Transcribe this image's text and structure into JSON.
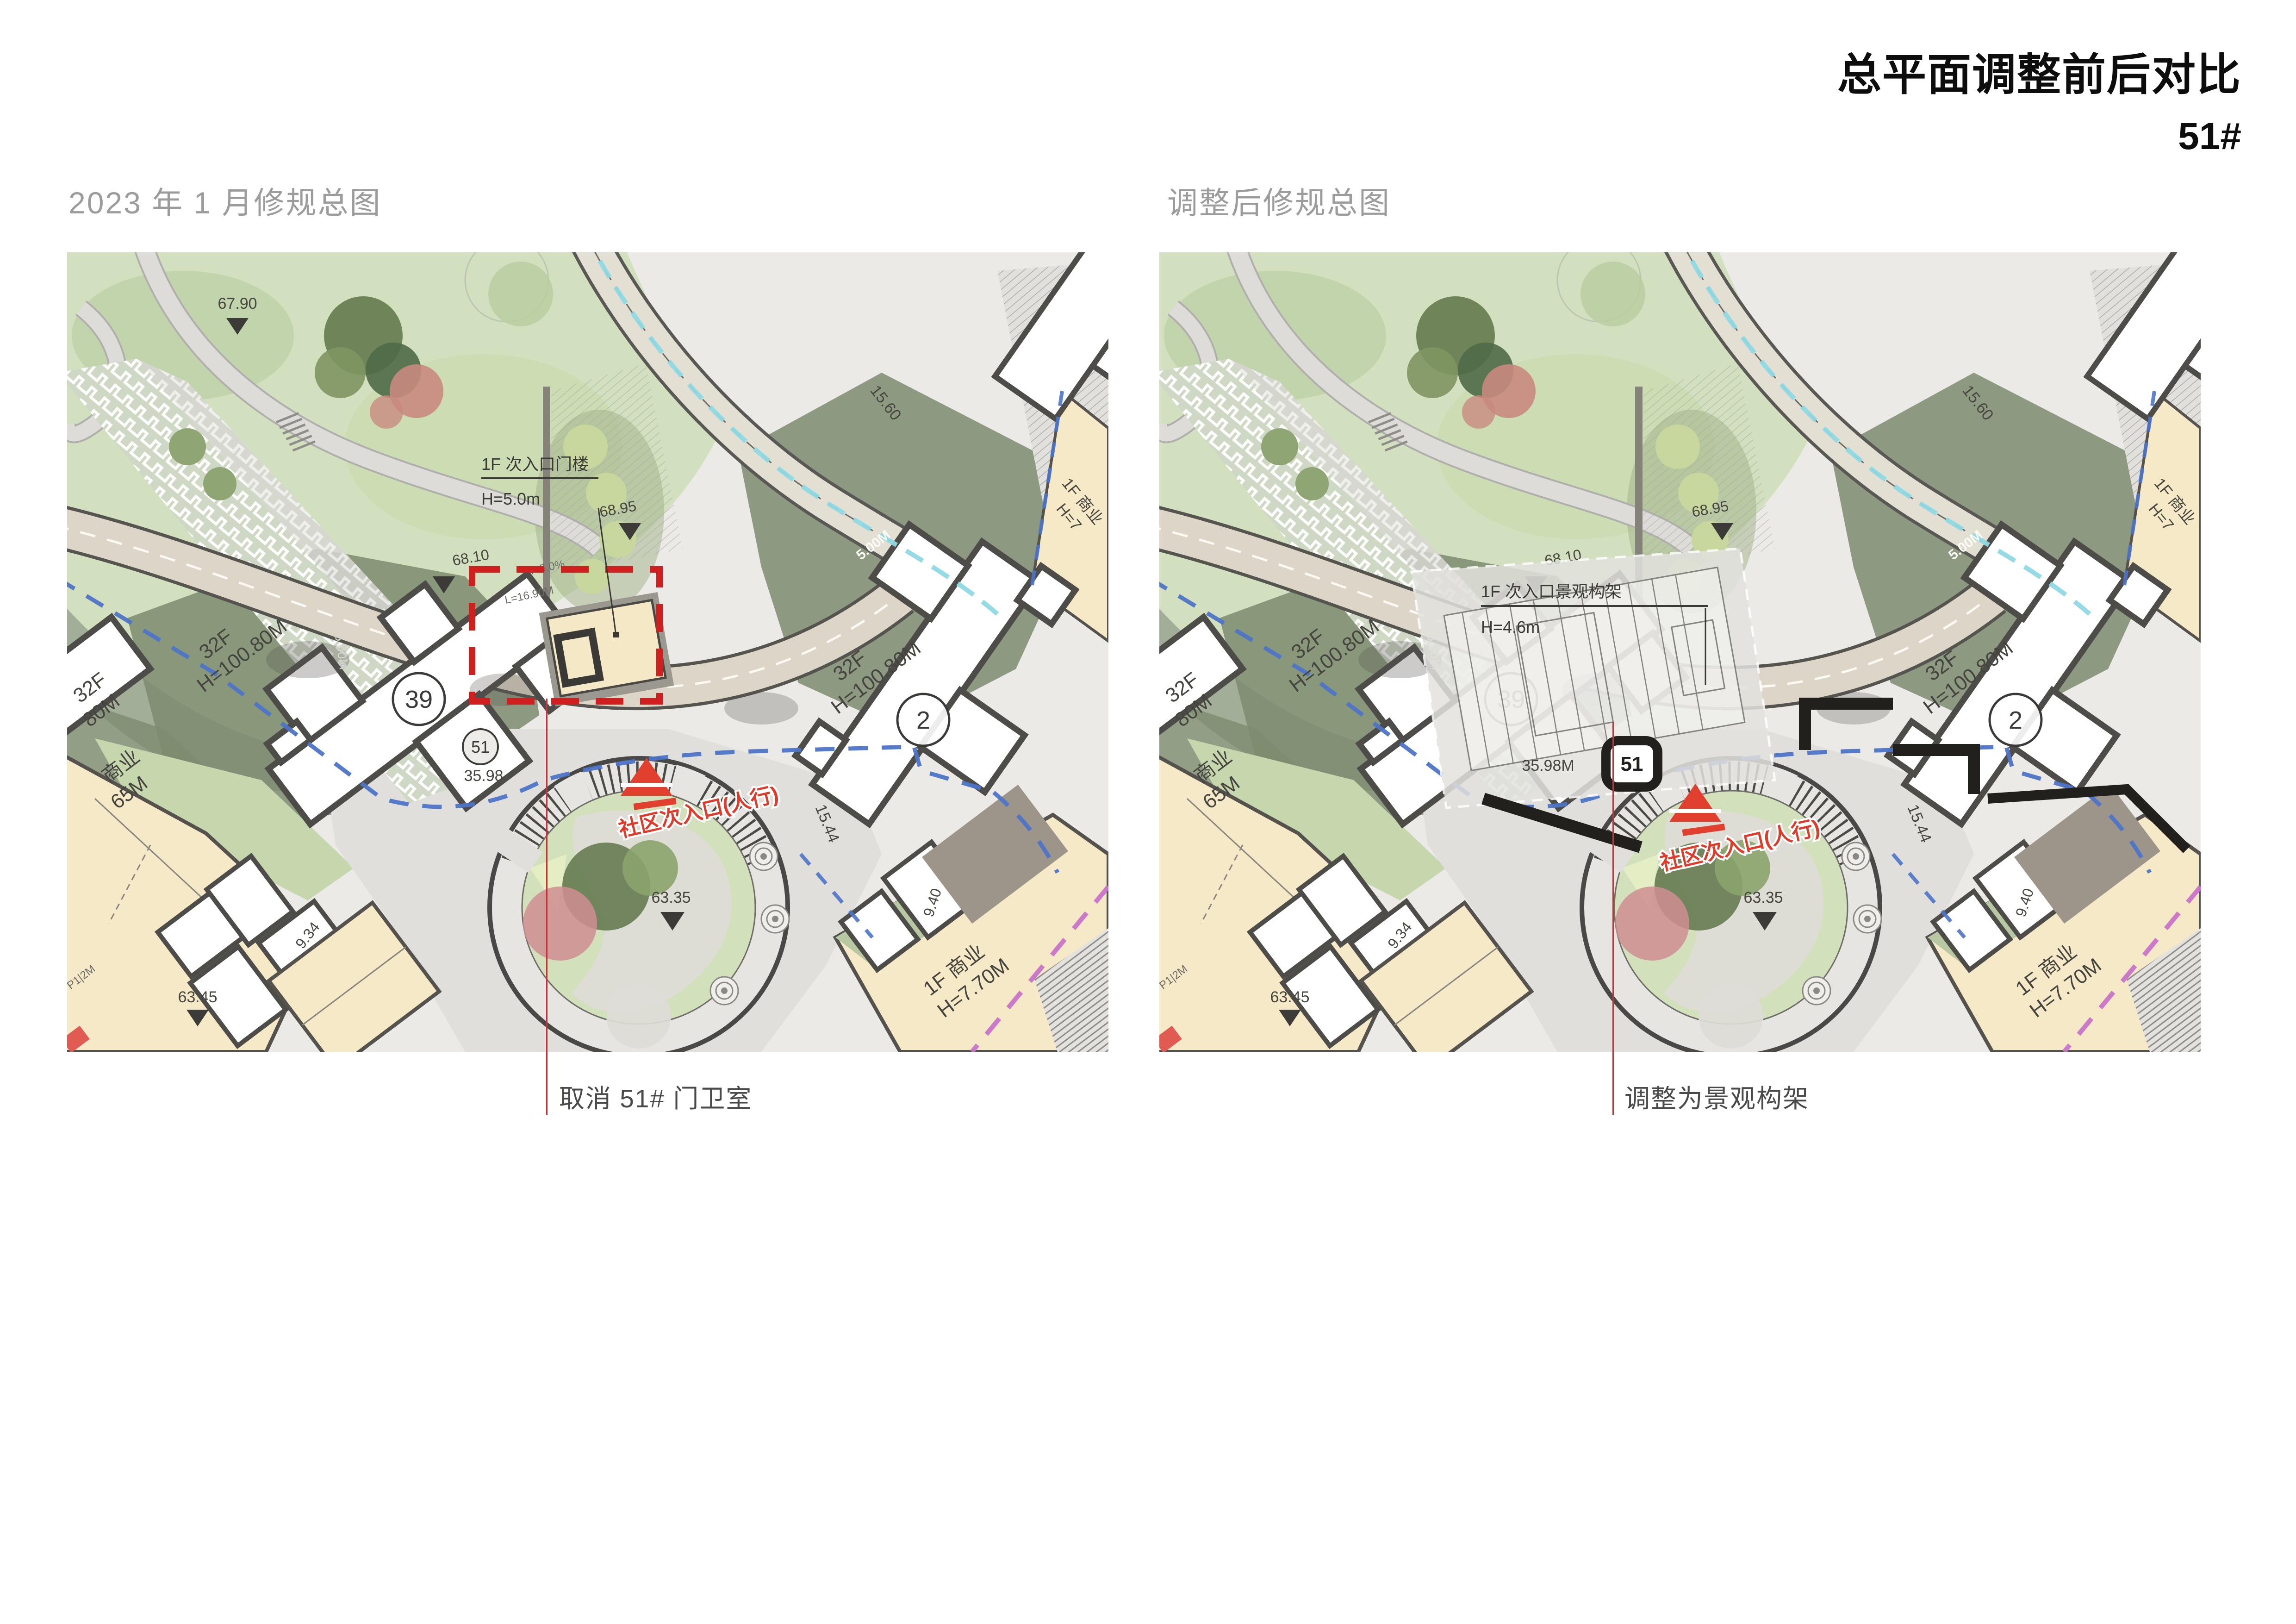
{
  "slide": {
    "title": "总平面调整前后对比",
    "subtitle": "51#"
  },
  "left_panel": {
    "caption": "2023 年 1 月修规总图",
    "annotation": "取消 51# 门卫室",
    "gate_line1": "1F 次入口门楼",
    "gate_line2": "H=5.0m",
    "unit_badge": "51",
    "level_3598": "35.98",
    "level_6790": "67.90"
  },
  "right_panel": {
    "caption": "调整后修规总图",
    "annotation": "调整为景观构架",
    "gate_line1": "1F 次入口景观构架",
    "gate_line2": "H=4.6m",
    "unit_badge": "51",
    "level_3598": "35.98M"
  },
  "map": {
    "bldg39": "39",
    "bldg2": "2",
    "tower_label1": "32F",
    "tower_label2": "H=100.80M",
    "tower_partial2": "80M",
    "commercial_label1": "1F 商业",
    "commercial_label2": "H=7.70M",
    "commercial_left1": "商业",
    "commercial_left2": "65M",
    "commercial_tr1": "1F 商业",
    "commercial_tr2": "H=7",
    "entrance_text": "社区次入口(人行)",
    "dim_1560": "15.60",
    "dim_1544": "15.44",
    "dim_934": "9.34",
    "dim_940": "9.40",
    "dim_500m": "5.00M",
    "level_6895": "68.95",
    "level_6810": "68.10",
    "level_6335": "63.35",
    "level_6345": "63.45",
    "slope": "i=5.0%",
    "length": "L=16.90M",
    "p12m": "P1|2M"
  },
  "colors": {
    "accent_red": "#d2302a",
    "dashed_red": "#cf1f1f",
    "route_blue": "#4d74c8",
    "cyan": "#8ed9e4",
    "magenta": "#c873c8",
    "beige": "#f6e9c7",
    "park_green": "#d2e0bf",
    "olive": "#7d8b6f"
  }
}
